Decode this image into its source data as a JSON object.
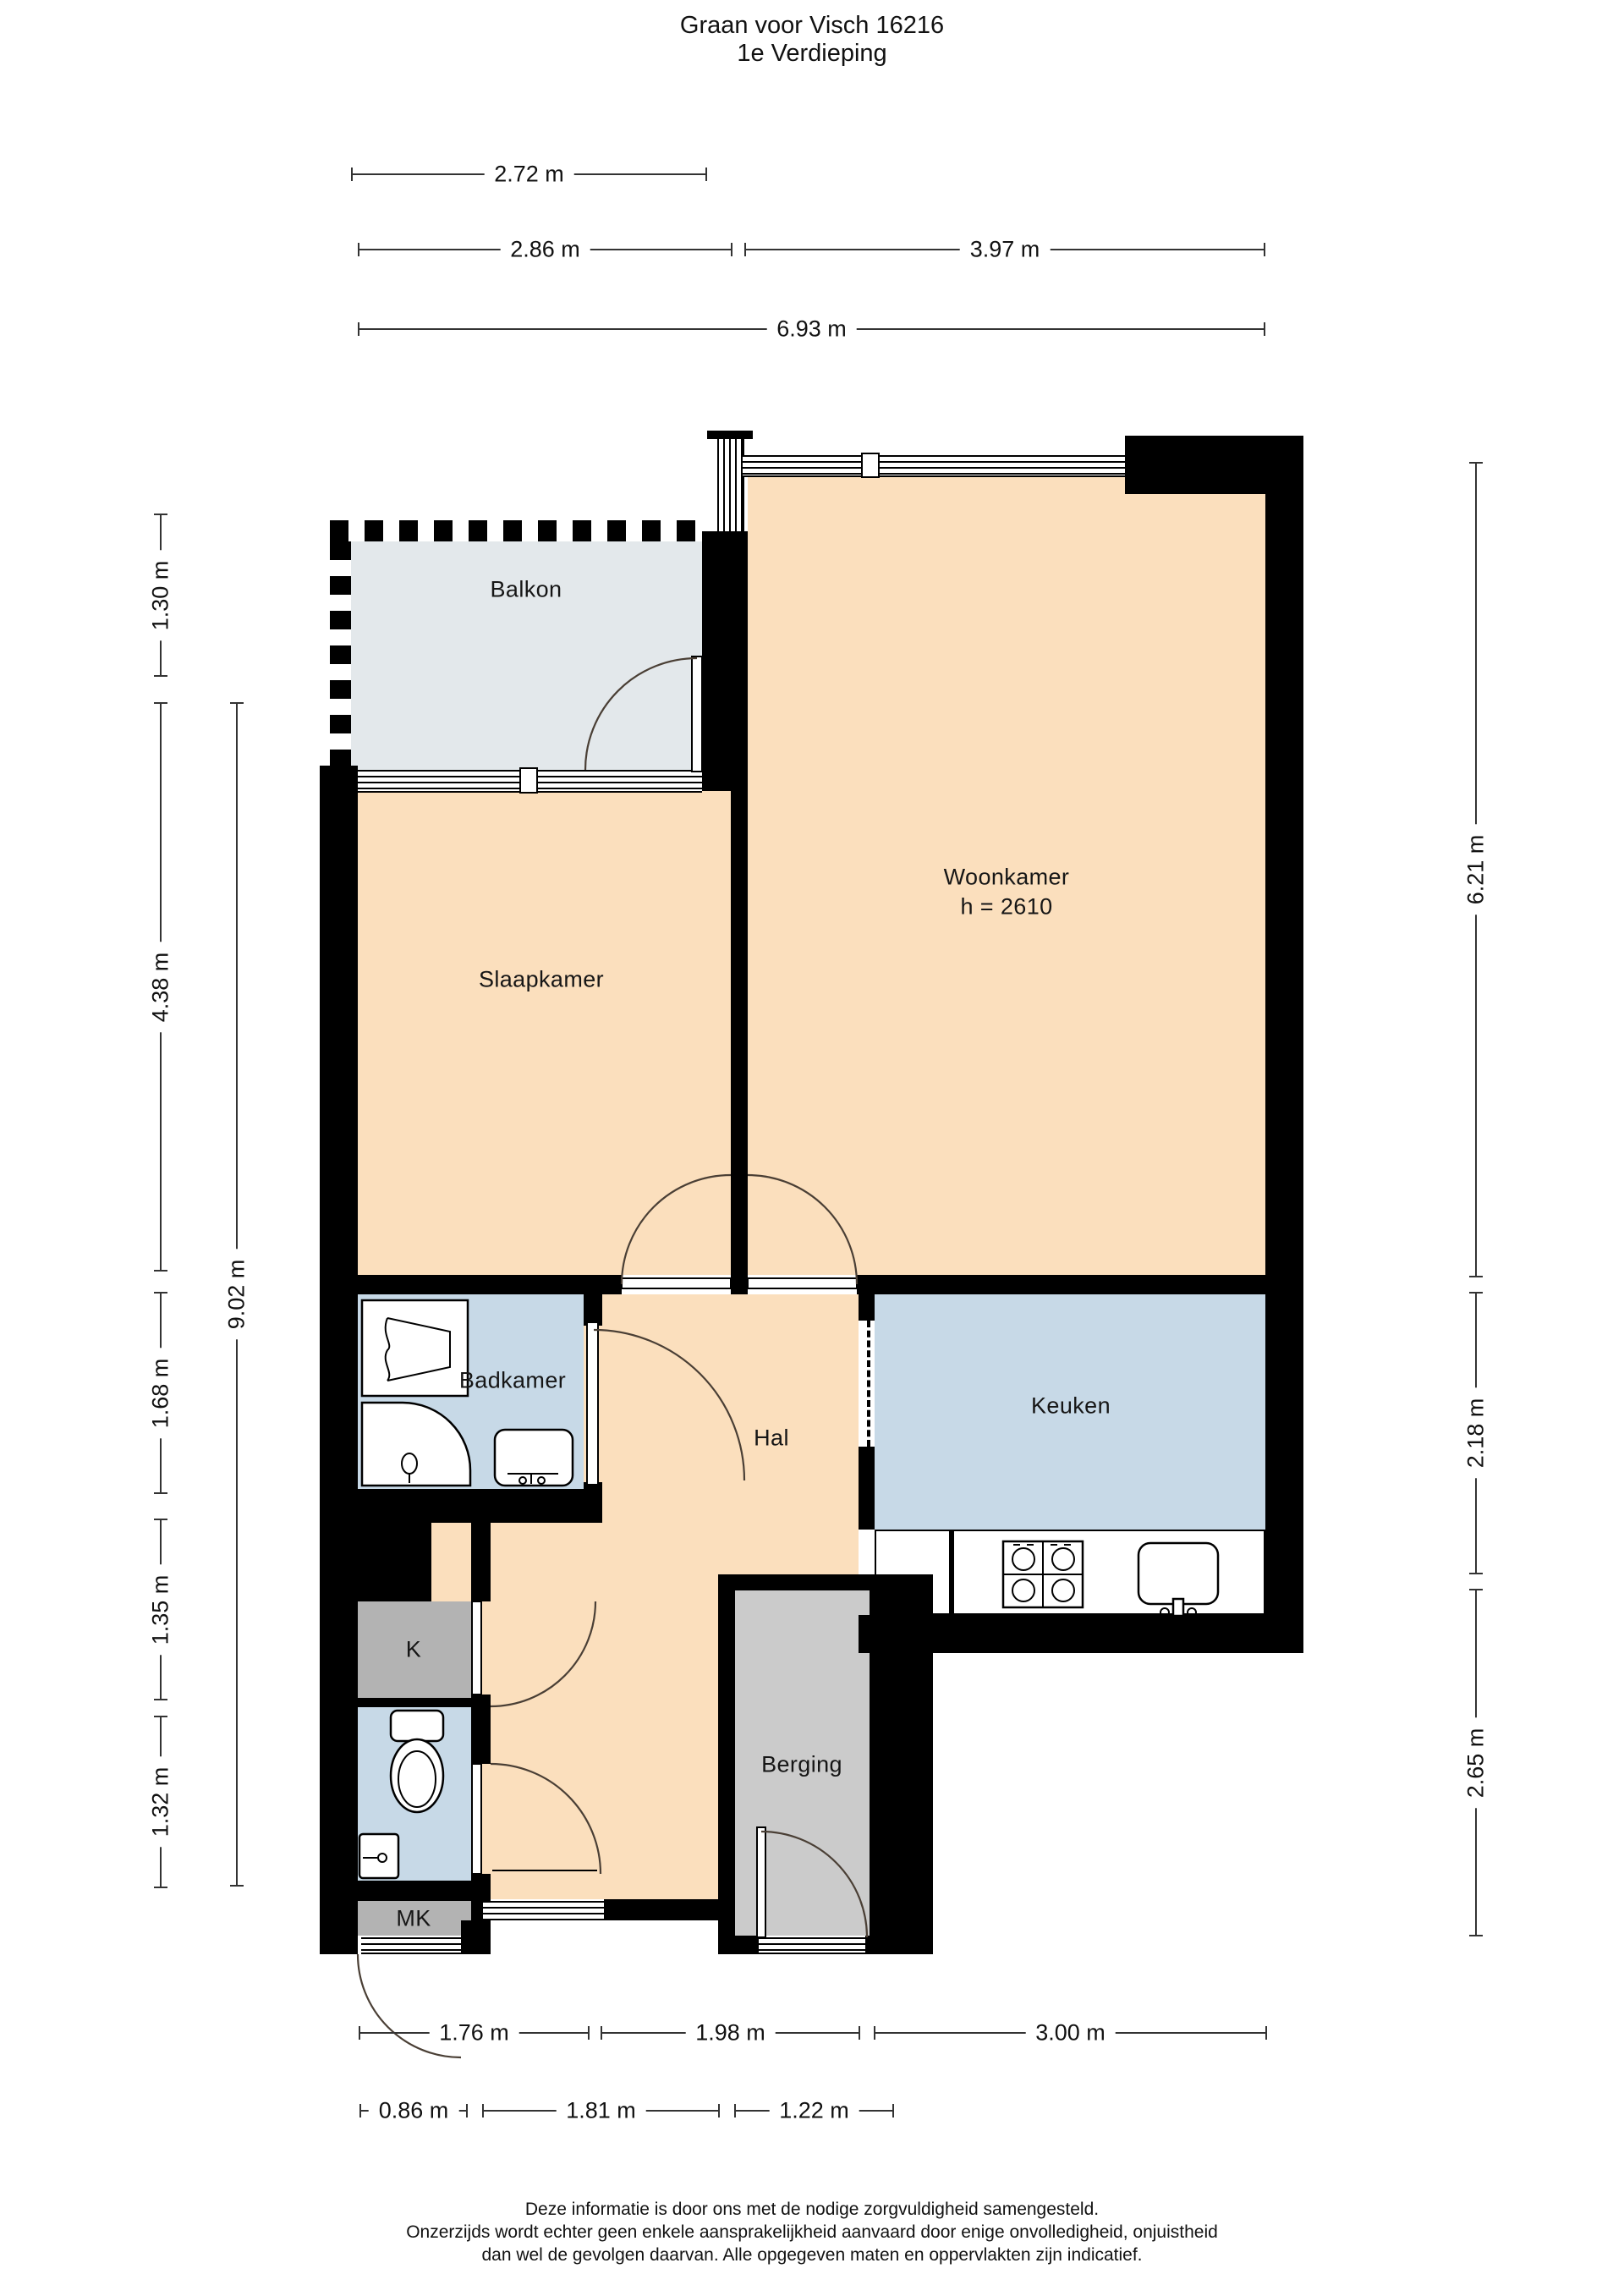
{
  "title": {
    "line1": "Graan voor Visch 16216",
    "line2": "1e Verdieping"
  },
  "rooms": {
    "balkon": "Balkon",
    "slaapkamer": "Slaapkamer",
    "woonkamer": "Woonkamer",
    "woonkamer_height": "h = 2610",
    "badkamer": "Badkamer",
    "hal": "Hal",
    "keuken": "Keuken",
    "kast": "K",
    "berging": "Berging",
    "meterkast": "MK"
  },
  "dims": {
    "t0": "2.72 m",
    "t1": "2.86 m",
    "t2": "3.97 m",
    "t3": "6.93 m",
    "l0": "1.30 m",
    "l1": "4.38 m",
    "l2": "1.68 m",
    "l3": "1.35 m",
    "l4": "1.32 m",
    "l5": "9.02 m",
    "r0": "6.21 m",
    "r1": "2.18 m",
    "r2": "2.65 m",
    "b0": "1.76 m",
    "b1": "1.98 m",
    "b2": "3.00 m",
    "b3": "0.86 m",
    "b4": "1.81 m",
    "b5": "1.22 m"
  },
  "footer": {
    "line1": "Deze informatie is door ons met de nodige zorgvuldigheid samengesteld.",
    "line2": "Onzerzijds wordt echter geen enkele aansprakelijkheid aanvaard door enige onvolledigheid, onjuistheid",
    "line3": "dan wel de gevolgen daarvan. Alle opgegeven maten en oppervlakten zijn indicatief."
  },
  "colors": {
    "peach": "#fbdfbd",
    "blue": "#c7d9e7",
    "balcony_gray": "#e3e8eb",
    "storage_gray": "#cbcbcb",
    "closet_gray": "#b3b3b3",
    "wall": "#000000"
  }
}
